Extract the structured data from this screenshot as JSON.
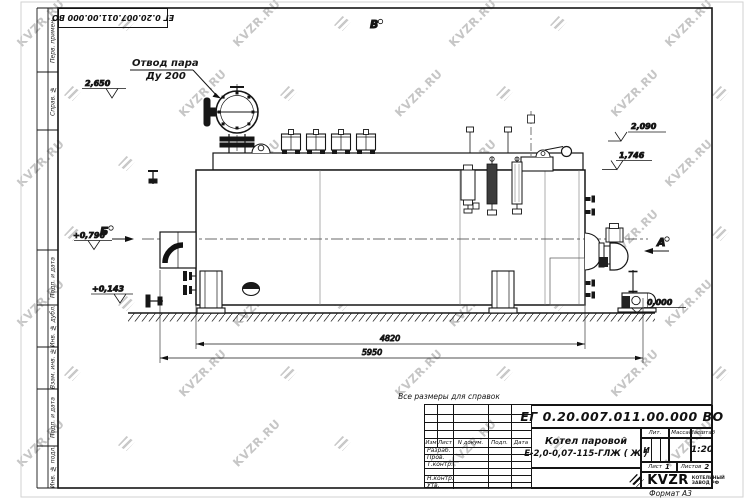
{
  "watermark": {
    "text": "KVZR.RU"
  },
  "top_stamp": {
    "doc_number": "ЕГ 0.20.007.011.00.000  ВО"
  },
  "margin": {
    "labels": [
      "Перв. примен.",
      "Справ. №",
      "Подп. и дата",
      "Инв. № дубл.",
      "Взам. инв. №",
      "Подп. и дата",
      "Инв. № подл."
    ]
  },
  "drawing": {
    "reference_note": "Все размеры для справок",
    "steam_outlet": {
      "line1": "Отвод пара",
      "line2": "Ду 200"
    },
    "levels": {
      "valve_top": "2,650",
      "drum_top": "2,090",
      "body_top": "1,746",
      "burner_axis": "+0,796",
      "lower": "+0,143",
      "ground": "0,000"
    },
    "dimensions": {
      "body_length": "4820",
      "overall_length": "5950"
    },
    "views": {
      "left": "Б",
      "top": "В",
      "right": "А"
    }
  },
  "title_block": {
    "doc_number": "ЕГ 0.20.007.011.00.000  ВО",
    "product_name_line1": "Котел паровой",
    "product_name_line2": "Е-2,0-0,07-115-ГЛЖ ( Ж )",
    "columns": {
      "izm": "Изм",
      "list": "Лист",
      "ndoc": "N докум.",
      "podp": "Подп.",
      "data": "Дата"
    },
    "rows": {
      "razrab": "Разраб.",
      "prov": "Пров.",
      "tkontr": "Т.контр.",
      "nkontr": "Н.контр.",
      "utv": "Утв."
    },
    "lit": {
      "label": "Лит.",
      "value": "И"
    },
    "massa": {
      "label": "Масса",
      "value": ""
    },
    "masshtab": {
      "label": "Масштаб",
      "value": "1:20"
    },
    "sheet": {
      "label": "Лист",
      "value": "1"
    },
    "sheets": {
      "label": "Листов",
      "value": "2"
    },
    "logo": {
      "text": "KVZR",
      "sub_line1": "КОТЕЛЬНЫЙ",
      "sub_line2": "ЗАВОД РФ"
    },
    "format": "Формат А3"
  }
}
